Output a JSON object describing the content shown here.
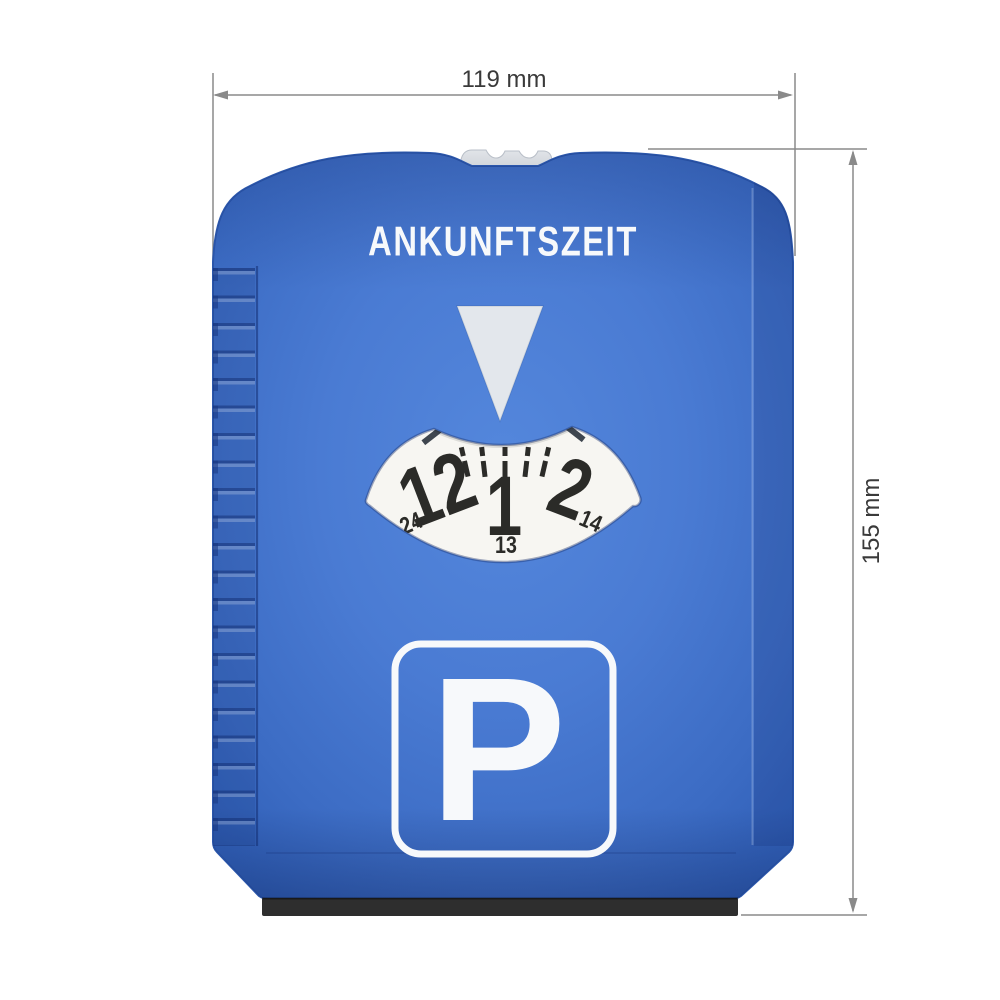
{
  "annotations": {
    "width_label": "119 mm",
    "height_label": "155 mm"
  },
  "parking_disc": {
    "title": "ANKUNFTSZEIT",
    "dial": {
      "main_times": [
        "12",
        "1",
        "2"
      ],
      "secondary_times": [
        "24",
        "13",
        "14"
      ]
    },
    "parking_sign": {
      "letter": "P"
    }
  },
  "colors": {
    "body_blue": "#4a7bd3",
    "body_blue_dark": "#2b57ac",
    "dial_face": "#f7f6f2",
    "dial_numbers": "#2b2b28",
    "pointer_gray": "#e3e7ec",
    "knob_gray": "#d7dbe0",
    "squeegee_black": "#2e2e2e",
    "dimension_line": "#8a8a8a",
    "dimension_text": "#3a3a3a",
    "sign_white": "#f7f9fb"
  }
}
